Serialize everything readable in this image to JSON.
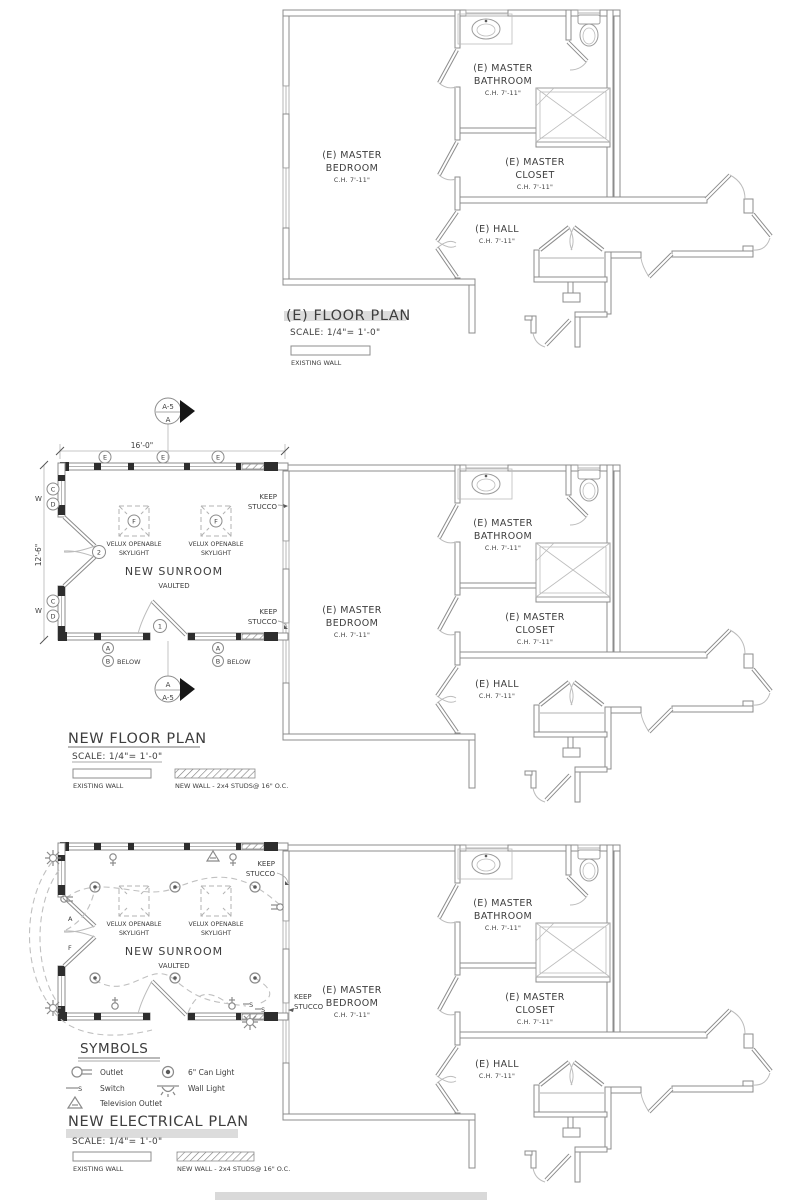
{
  "document": {
    "plan_existing": {
      "title": "(E) FLOOR PLAN",
      "scale": "SCALE: 1/4\"= 1'-0\"",
      "legend_existing_wall": "EXISTING WALL"
    },
    "plan_new_floor": {
      "title": "NEW FLOOR PLAN",
      "scale": "SCALE: 1/4\"= 1'-0\"",
      "legend_existing_wall": "EXISTING WALL",
      "legend_new_wall": "NEW WALL - 2x4 STUDS@ 16\" O.C."
    },
    "plan_electrical": {
      "title": "NEW ELECTRICAL PLAN",
      "scale": "SCALE: 1/4\"= 1'-0\"",
      "legend_existing_wall": "EXISTING WALL",
      "legend_new_wall": "NEW WALL - 2x4 STUDS@ 16\" O.C.",
      "symbols_title": "SYMBOLS",
      "symbols": [
        {
          "name": "outlet",
          "label": "Outlet"
        },
        {
          "name": "switch",
          "label": "Switch"
        },
        {
          "name": "television-outlet",
          "label": "Television Outlet"
        },
        {
          "name": "can-light",
          "label": "6\" Can Light"
        },
        {
          "name": "wall-light",
          "label": "Wall Light"
        }
      ]
    },
    "rooms": {
      "master_bedroom": {
        "line1": "(E) MASTER",
        "line2": "BEDROOM",
        "ceiling": "C.H. 7'-11\""
      },
      "master_bathroom": {
        "line1": "(E) MASTER",
        "line2": "BATHROOM",
        "ceiling": "C.H. 7'-11\""
      },
      "master_closet": {
        "line1": "(E) MASTER",
        "line2": "CLOSET",
        "ceiling": "C.H. 7'-11\""
      },
      "hall": {
        "line1": "(E) HALL",
        "ceiling": "C.H. 7'-11\""
      }
    },
    "sunroom": {
      "name": "NEW SUNROOM",
      "subtitle": "VAULTED",
      "skylight_line1": "VELUX OPENABLE",
      "skylight_line2": "SKYLIGHT",
      "keep_stucco_line1": "KEEP",
      "keep_stucco_line2": "STUCCO",
      "width_dim": "16'-0\"",
      "depth_dim": "12'-6\"",
      "below_label": "BELOW",
      "section_ref": "A-5",
      "section_letter": "A",
      "markers": {
        "e": "E",
        "c": "C",
        "d": "D",
        "w": "W",
        "a": "A",
        "b": "B",
        "f": "F",
        "keynote1": "1",
        "keynote2": "2",
        "door_a": "A",
        "door_f": "F",
        "switch": "S"
      }
    }
  }
}
